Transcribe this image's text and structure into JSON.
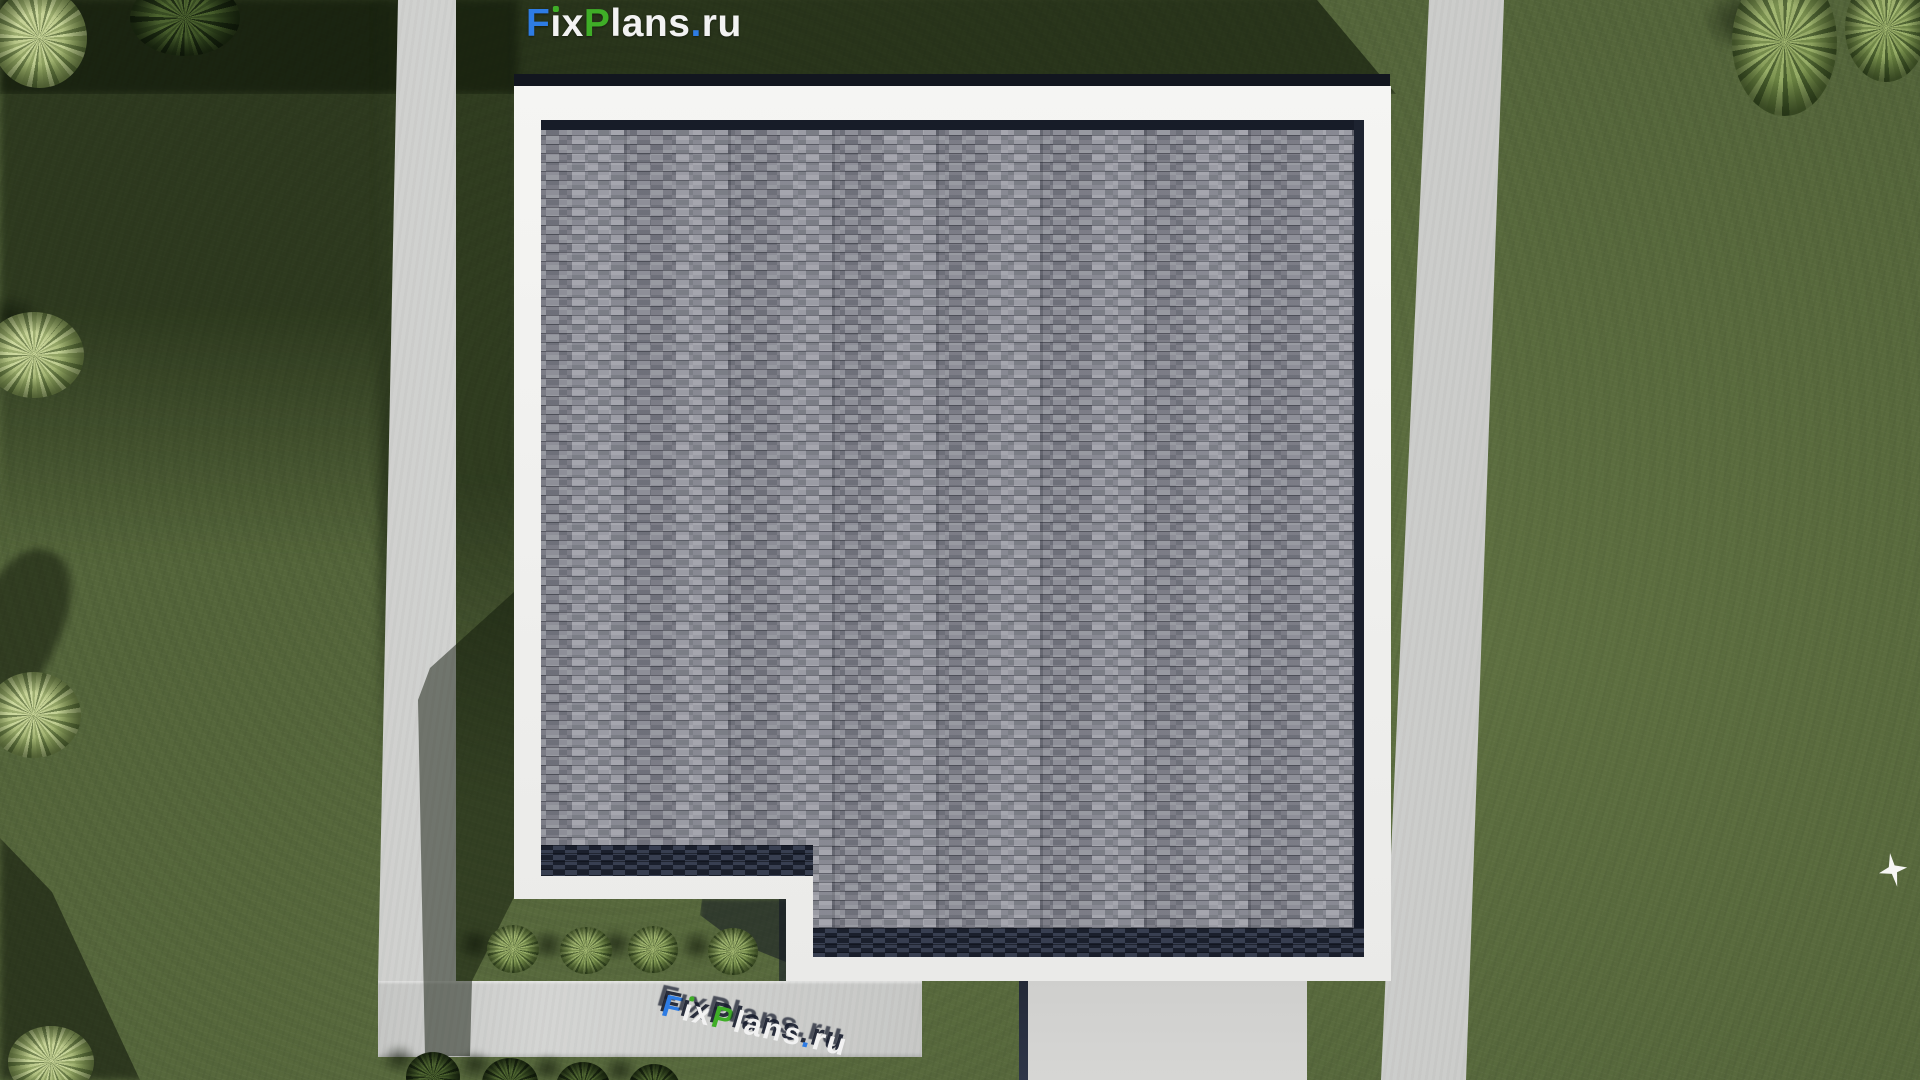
{
  "brand": {
    "name": "FixPlans.ru",
    "watermark_segments": [
      {
        "text": "F",
        "color": "#2e7ce4"
      },
      {
        "text": "i",
        "color": "#f2f2f2",
        "dot": "#3fae27"
      },
      {
        "text": "x",
        "color": "#f2f2f2"
      },
      {
        "text": "P",
        "color": "#3fae27"
      },
      {
        "text": "lans",
        "color": "#f2f2f2"
      },
      {
        "text": ".",
        "color": "#2e7ce4"
      },
      {
        "text": "ru",
        "color": "#f2f2f2"
      }
    ]
  },
  "scene": {
    "view": "top-down aerial 3D architectural render of a single-family house lot",
    "building": "flat roof covered with gray interlocking shingle tiles, white parapet border, dark slate edge bands, L-shaped notch garden at the lower-left corner",
    "ground": "lawn with concrete walkways on the left and right of the lot, a sidewalk along the bottom and a driveway below the house",
    "vegetation": "ornamental bushes: two at top-left, two at top-right, two on the left edge, one at bottom-left corner, four in the notch garden, four along the bottom sidewalk",
    "bird": "small white bird flying over the grass near the right edge",
    "ground_logo": "extruded 3D FixPlans.ru lettering standing on the bottom sidewalk casting shadows up-left"
  },
  "colors": {
    "grass-base": "#55663b",
    "path-concrete": "#d2d3d1",
    "driveway-concrete": "#d6d6d4",
    "parapet-white": "#f1f1ef",
    "roof-base": "#8e8f97",
    "roof-edge-navy": "#262c3b",
    "wall-edge-dark": "#12161f",
    "bird-white": "#f6f6f4"
  }
}
